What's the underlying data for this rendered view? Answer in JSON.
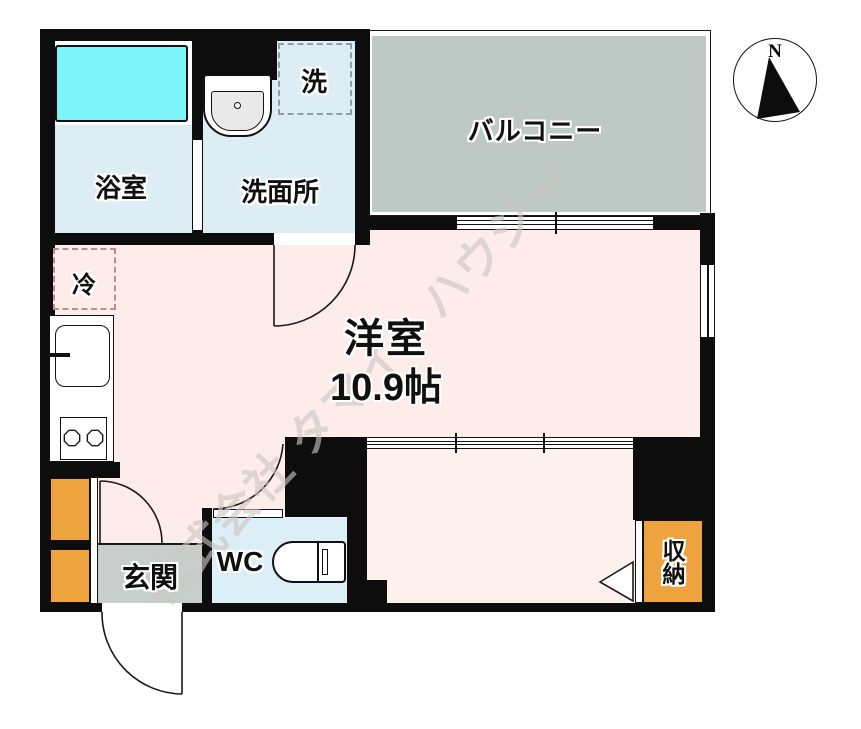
{
  "plan": {
    "labels": {
      "bath": "浴室",
      "washroom": "洗面所",
      "washer_space": "洗",
      "balcony": "バルコニー",
      "room_name": "洋室",
      "room_size": "10.9帖",
      "fridge_space": "冷",
      "entrance": "玄関",
      "toilet": "WC",
      "storage": "収納"
    },
    "compass": {
      "north": "N"
    },
    "watermark": "株式会社 タマイ・ハウジー",
    "colors": {
      "wall": "#0d0d0d",
      "room_floor": "#fdecea",
      "alcove_floor": "#fdf1ee",
      "wet_area_floor": "#ddedf4",
      "wc_floor": "#ddeff6",
      "balcony_floor": "#bec9c5",
      "entrance_floor": "#c7cecb",
      "storage_fill": "#eda43e",
      "bathtub_fill": "#7df5f8"
    }
  }
}
